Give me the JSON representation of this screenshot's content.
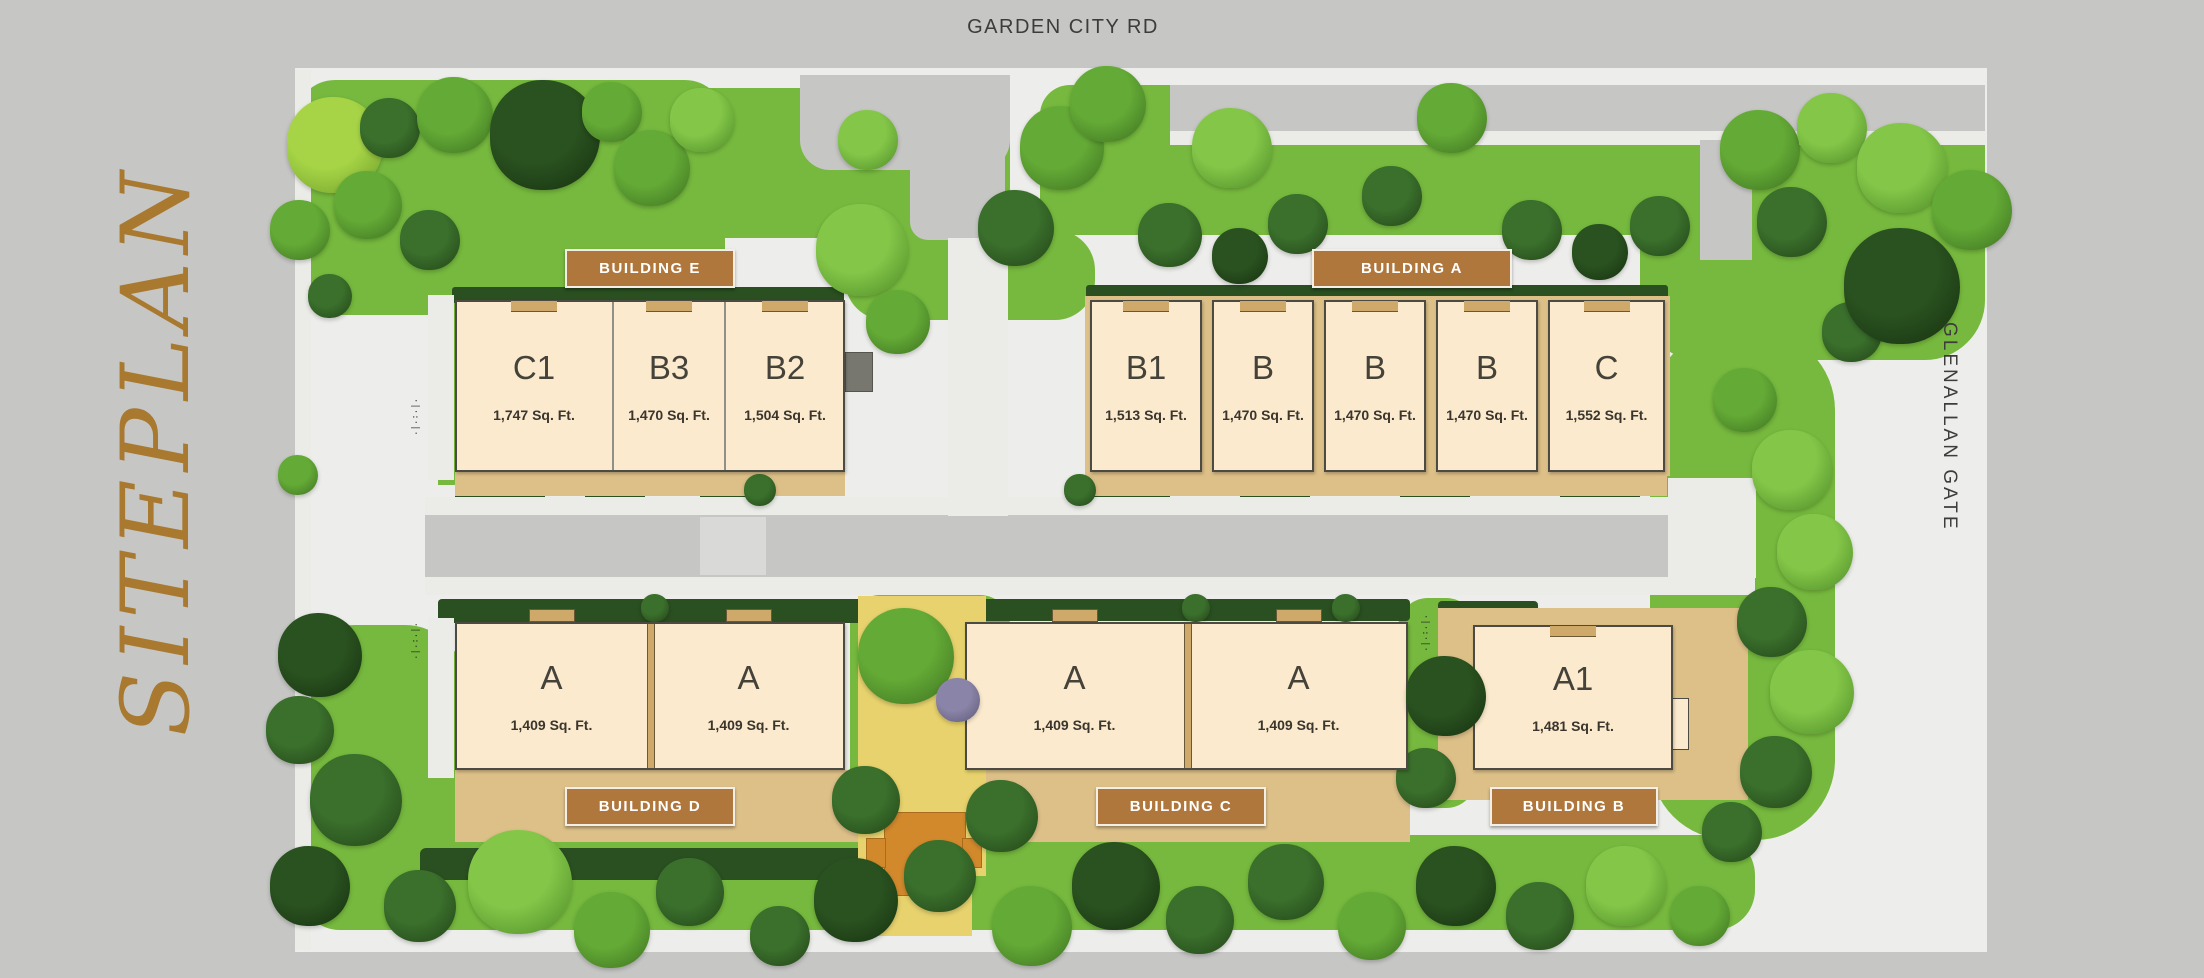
{
  "labels": {
    "top_road": "GARDEN CITY RD",
    "left_title": "SITEPLAN",
    "right_road": "GLENALLAN GATE"
  },
  "colors": {
    "page_bg": "#c6c6c5",
    "site_bg": "#ededeb",
    "building_fill": "#fbeacd",
    "building_border": "#4b4a43",
    "badge_bg": "#b0773c",
    "badge_border": "#f3efe7",
    "badge_text": "#ffffff",
    "unit_text": "#45423a",
    "road": "#c6c6c4",
    "sidewalk": "#ebebe8",
    "apron": "#ddc088",
    "wall_tan": "#cfa96a",
    "hedge": "#2a4f21",
    "grass": "#76b93e",
    "path_yellow": "#e7d26d",
    "patio_orange": "#d2892c",
    "street_text": "#3c3c3c",
    "title_gold": "#a8792e",
    "tree_palette": {
      "lg": [
        "#84c648",
        "#4c8a28"
      ],
      "mg": [
        "#64aa36",
        "#3c7020"
      ],
      "dg": [
        "#3a6f2c",
        "#224417"
      ],
      "dd": [
        "#2a5220",
        "#16300f"
      ],
      "yg": [
        "#a6d446",
        "#6d9c2a"
      ],
      "pu": [
        "#8a84a8",
        "#5c5876"
      ]
    }
  },
  "buildings": [
    {
      "id": "e",
      "badge": {
        "label": "BUILDING E",
        "x": 565,
        "y": 249,
        "w": 170,
        "h": 39
      },
      "box": {
        "x": 455,
        "y": 300,
        "w": 390,
        "h": 172
      },
      "type": "attached",
      "notch": "in",
      "divider": "line",
      "units": [
        {
          "label": "C1",
          "sqft": "1,747 Sq. Ft.",
          "x": 0,
          "w": 158
        },
        {
          "label": "B3",
          "sqft": "1,470 Sq. Ft.",
          "x": 158,
          "w": 112
        },
        {
          "label": "B2",
          "sqft": "1,504 Sq. Ft.",
          "x": 270,
          "w": 120
        }
      ]
    },
    {
      "id": "a",
      "badge": {
        "label": "BUILDING A",
        "x": 1312,
        "y": 249,
        "w": 200,
        "h": 39
      },
      "box": {
        "x": 1090,
        "y": 300,
        "w": 575,
        "h": 172
      },
      "type": "detached",
      "notch": "in",
      "divider": "gap",
      "units": [
        {
          "label": "B1",
          "sqft": "1,513 Sq. Ft.",
          "x": 0,
          "w": 112
        },
        {
          "label": "B",
          "sqft": "1,470 Sq. Ft.",
          "x": 122,
          "w": 102
        },
        {
          "label": "B",
          "sqft": "1,470 Sq. Ft.",
          "x": 234,
          "w": 102
        },
        {
          "label": "B",
          "sqft": "1,470 Sq. Ft.",
          "x": 346,
          "w": 102
        },
        {
          "label": "C",
          "sqft": "1,552 Sq. Ft.",
          "x": 458,
          "w": 117
        }
      ]
    },
    {
      "id": "d",
      "badge": {
        "label": "BUILDING D",
        "x": 565,
        "y": 787,
        "w": 170,
        "h": 39
      },
      "box": {
        "x": 455,
        "y": 622,
        "w": 390,
        "h": 148
      },
      "type": "attached",
      "notch": "out",
      "divider": "tan",
      "units": [
        {
          "label": "A",
          "sqft": "1,409 Sq. Ft.",
          "x": 0,
          "w": 193
        },
        {
          "label": "A",
          "sqft": "1,409 Sq. Ft.",
          "x": 197,
          "w": 193
        }
      ]
    },
    {
      "id": "c",
      "badge": {
        "label": "BUILDING C",
        "x": 1096,
        "y": 787,
        "w": 170,
        "h": 39
      },
      "box": {
        "x": 965,
        "y": 622,
        "w": 443,
        "h": 148
      },
      "type": "attached",
      "notch": "out",
      "divider": "tan",
      "units": [
        {
          "label": "A",
          "sqft": "1,409 Sq. Ft.",
          "x": 0,
          "w": 219
        },
        {
          "label": "A",
          "sqft": "1,409 Sq. Ft.",
          "x": 224,
          "w": 219
        }
      ]
    },
    {
      "id": "b",
      "badge": {
        "label": "BUILDING B",
        "x": 1490,
        "y": 787,
        "w": 168,
        "h": 39
      },
      "box": {
        "x": 1473,
        "y": 625,
        "w": 200,
        "h": 145
      },
      "type": "attached",
      "notch": "in",
      "divider": "line",
      "units": [
        {
          "label": "A1",
          "sqft": "1,481 Sq. Ft.",
          "x": 0,
          "w": 200
        }
      ]
    }
  ],
  "decor": {
    "greens": [
      {
        "x": 295,
        "y": 80,
        "w": 430,
        "h": 235,
        "c": "grass",
        "r": "40px"
      },
      {
        "x": 640,
        "y": 88,
        "w": 370,
        "h": 150,
        "c": "grass",
        "r": "50px"
      },
      {
        "x": 1040,
        "y": 85,
        "w": 945,
        "h": 150,
        "c": "grass",
        "r": "30px"
      },
      {
        "x": 1640,
        "y": 130,
        "w": 345,
        "h": 230,
        "c": "grass",
        "r": "60px"
      },
      {
        "x": 1650,
        "y": 330,
        "w": 185,
        "h": 510,
        "c": "grass",
        "r": "80px"
      },
      {
        "x": 300,
        "y": 835,
        "w": 1455,
        "h": 95,
        "c": "grass",
        "r": "40px"
      },
      {
        "x": 295,
        "y": 625,
        "w": 170,
        "h": 300,
        "c": "grass",
        "r": "60px"
      },
      {
        "x": 850,
        "y": 595,
        "w": 160,
        "h": 250,
        "c": "grass",
        "r": "30px"
      },
      {
        "x": 1398,
        "y": 598,
        "w": 78,
        "h": 210,
        "c": "grass",
        "r": "30px"
      },
      {
        "x": 845,
        "y": 230,
        "w": 250,
        "h": 90,
        "c": "grass",
        "r": "40px"
      },
      {
        "x": 438,
        "y": 295,
        "w": 18,
        "h": 190,
        "c": "grass"
      },
      {
        "x": 452,
        "y": 287,
        "w": 392,
        "h": 16,
        "c": "hedge",
        "r": "3px"
      },
      {
        "x": 1086,
        "y": 285,
        "w": 582,
        "h": 16,
        "c": "hedge",
        "r": "3px"
      },
      {
        "x": 438,
        "y": 599,
        "w": 428,
        "h": 24,
        "c": "hedge",
        "r": "4px"
      },
      {
        "x": 960,
        "y": 599,
        "w": 450,
        "h": 22,
        "c": "hedge",
        "r": "4px"
      },
      {
        "x": 1438,
        "y": 601,
        "w": 100,
        "h": 22,
        "c": "hedge",
        "r": "4px"
      },
      {
        "x": 455,
        "y": 488,
        "w": 90,
        "h": 22,
        "c": "hedge",
        "r": "4px"
      },
      {
        "x": 585,
        "y": 488,
        "w": 60,
        "h": 22,
        "c": "hedge",
        "r": "4px"
      },
      {
        "x": 700,
        "y": 488,
        "w": 70,
        "h": 22,
        "c": "hedge",
        "r": "4px"
      },
      {
        "x": 1090,
        "y": 488,
        "w": 80,
        "h": 22,
        "c": "hedge",
        "r": "4px"
      },
      {
        "x": 1240,
        "y": 488,
        "w": 70,
        "h": 22,
        "c": "hedge",
        "r": "4px"
      },
      {
        "x": 1400,
        "y": 488,
        "w": 70,
        "h": 22,
        "c": "hedge",
        "r": "4px"
      },
      {
        "x": 1560,
        "y": 488,
        "w": 80,
        "h": 22,
        "c": "hedge",
        "r": "4px"
      },
      {
        "x": 420,
        "y": 848,
        "w": 500,
        "h": 32,
        "c": "hedge",
        "r": "6px"
      }
    ],
    "roads": [
      {
        "x": 295,
        "y": 70,
        "w": 16,
        "h": 880,
        "c": "sidewalk"
      },
      {
        "x": 425,
        "y": 497,
        "w": 1330,
        "h": 18,
        "c": "sidewalk"
      },
      {
        "x": 425,
        "y": 577,
        "w": 1330,
        "h": 18,
        "c": "sidewalk"
      },
      {
        "x": 425,
        "y": 515,
        "w": 1330,
        "h": 62,
        "c": "road"
      },
      {
        "x": 800,
        "y": 75,
        "w": 210,
        "h": 95,
        "c": "road",
        "r": "0 0 30px 30px"
      },
      {
        "x": 910,
        "y": 75,
        "w": 95,
        "h": 165,
        "c": "road",
        "r": "0 0 18px 18px"
      },
      {
        "x": 948,
        "y": 238,
        "w": 60,
        "h": 278,
        "c": "sidewalk"
      },
      {
        "x": 1170,
        "y": 85,
        "w": 815,
        "h": 46,
        "c": "road"
      },
      {
        "x": 1170,
        "y": 131,
        "w": 815,
        "h": 14,
        "c": "sidewalk"
      },
      {
        "x": 1700,
        "y": 140,
        "w": 52,
        "h": 120,
        "c": "road"
      },
      {
        "x": 1668,
        "y": 478,
        "w": 88,
        "h": 100,
        "c": "sidewalk"
      },
      {
        "x": 700,
        "y": 517,
        "w": 66,
        "h": 58,
        "c": "#d9d9d7"
      },
      {
        "x": 428,
        "y": 295,
        "w": 26,
        "h": 185,
        "c": "sidewalk"
      },
      {
        "x": 428,
        "y": 618,
        "w": 26,
        "h": 160,
        "c": "sidewalk"
      },
      {
        "x": 1445,
        "y": 620,
        "w": 26,
        "h": 155,
        "c": "sidewalk"
      }
    ],
    "aprons": [
      {
        "x": 455,
        "y": 470,
        "w": 390,
        "h": 26,
        "c": "apron"
      },
      {
        "x": 1085,
        "y": 472,
        "w": 582,
        "h": 24,
        "c": "apron"
      },
      {
        "x": 1085,
        "y": 296,
        "w": 585,
        "h": 180,
        "c": "apron"
      },
      {
        "x": 455,
        "y": 770,
        "w": 408,
        "h": 72,
        "c": "apron"
      },
      {
        "x": 962,
        "y": 770,
        "w": 448,
        "h": 72,
        "c": "apron"
      },
      {
        "x": 1438,
        "y": 608,
        "w": 310,
        "h": 192,
        "c": "apron"
      },
      {
        "x": 858,
        "y": 596,
        "w": 128,
        "h": 280,
        "c": "path_yellow"
      },
      {
        "x": 872,
        "y": 876,
        "w": 100,
        "h": 60,
        "c": "path_yellow"
      },
      {
        "x": 884,
        "y": 812,
        "w": 80,
        "h": 82,
        "c": "patio_orange",
        "br": "#a96c1e"
      },
      {
        "x": 866,
        "y": 838,
        "w": 18,
        "h": 28,
        "c": "patio_orange",
        "br": "#a96c1e"
      },
      {
        "x": 962,
        "y": 838,
        "w": 18,
        "h": 28,
        "c": "patio_orange",
        "br": "#a96c1e"
      },
      {
        "x": 845,
        "y": 352,
        "w": 26,
        "h": 38,
        "c": "#77776f",
        "br": "#55544e"
      },
      {
        "x": 1671,
        "y": 698,
        "w": 16,
        "h": 50,
        "c": "building_fill",
        "br": "#4b4a43"
      }
    ],
    "trees": [
      [
        335,
        145,
        48,
        "yg"
      ],
      [
        300,
        230,
        30,
        "mg"
      ],
      [
        390,
        128,
        30,
        "dg"
      ],
      [
        455,
        115,
        38,
        "mg"
      ],
      [
        545,
        135,
        55,
        "dd"
      ],
      [
        612,
        112,
        30,
        "mg"
      ],
      [
        652,
        168,
        38,
        "mg"
      ],
      [
        702,
        120,
        32,
        "lg"
      ],
      [
        368,
        205,
        34,
        "mg"
      ],
      [
        430,
        240,
        30,
        "dg"
      ],
      [
        330,
        296,
        22,
        "dg"
      ],
      [
        298,
        475,
        20,
        "mg"
      ],
      [
        862,
        250,
        46,
        "lg",
        "o"
      ],
      [
        898,
        322,
        32,
        "mg",
        "o"
      ],
      [
        1016,
        228,
        38,
        "dg"
      ],
      [
        1062,
        148,
        42,
        "mg"
      ],
      [
        1108,
        104,
        38,
        "mg"
      ],
      [
        868,
        140,
        30,
        "lg"
      ],
      [
        1170,
        235,
        32,
        "dg"
      ],
      [
        1240,
        256,
        28,
        "dd"
      ],
      [
        1298,
        224,
        30,
        "dg"
      ],
      [
        1532,
        230,
        30,
        "dg"
      ],
      [
        1600,
        252,
        28,
        "dd"
      ],
      [
        1660,
        226,
        30,
        "dg"
      ],
      [
        1232,
        148,
        40,
        "lg"
      ],
      [
        1452,
        118,
        35,
        "mg"
      ],
      [
        1392,
        196,
        30,
        "dg"
      ],
      [
        1760,
        150,
        40,
        "mg"
      ],
      [
        1832,
        128,
        35,
        "lg"
      ],
      [
        1902,
        168,
        45,
        "lg"
      ],
      [
        1792,
        222,
        35,
        "dg"
      ],
      [
        1902,
        286,
        58,
        "dd",
        "o"
      ],
      [
        1972,
        210,
        40,
        "mg"
      ],
      [
        1852,
        332,
        30,
        "dg"
      ],
      [
        1745,
        400,
        32,
        "mg"
      ],
      [
        1792,
        470,
        40,
        "lg"
      ],
      [
        1815,
        552,
        38,
        "lg"
      ],
      [
        1772,
        622,
        35,
        "dg"
      ],
      [
        1812,
        692,
        42,
        "lg"
      ],
      [
        1776,
        772,
        36,
        "dg"
      ],
      [
        1732,
        832,
        30,
        "dg"
      ],
      [
        320,
        655,
        42,
        "dd"
      ],
      [
        300,
        730,
        34,
        "dg"
      ],
      [
        356,
        800,
        46,
        "dg"
      ],
      [
        310,
        886,
        40,
        "dd"
      ],
      [
        420,
        906,
        36,
        "dg"
      ],
      [
        520,
        882,
        52,
        "lg"
      ],
      [
        612,
        930,
        38,
        "mg"
      ],
      [
        690,
        892,
        34,
        "dg"
      ],
      [
        780,
        936,
        30,
        "dg"
      ],
      [
        856,
        900,
        42,
        "dd"
      ],
      [
        940,
        876,
        36,
        "dg"
      ],
      [
        1032,
        926,
        40,
        "mg"
      ],
      [
        1116,
        886,
        44,
        "dd"
      ],
      [
        1200,
        920,
        34,
        "dg"
      ],
      [
        1286,
        882,
        38,
        "dg"
      ],
      [
        1372,
        926,
        34,
        "mg"
      ],
      [
        1456,
        886,
        40,
        "dd"
      ],
      [
        1540,
        916,
        34,
        "dg"
      ],
      [
        1626,
        886,
        40,
        "lg"
      ],
      [
        1700,
        916,
        30,
        "mg"
      ],
      [
        906,
        656,
        48,
        "mg",
        "o"
      ],
      [
        958,
        700,
        22,
        "pu",
        "o"
      ],
      [
        866,
        800,
        34,
        "dg"
      ],
      [
        1002,
        816,
        36,
        "dg",
        "o"
      ],
      [
        1446,
        696,
        40,
        "dd",
        "o"
      ],
      [
        1426,
        778,
        30,
        "dg"
      ],
      [
        655,
        608,
        14,
        "dg"
      ],
      [
        1196,
        608,
        14,
        "dg"
      ],
      [
        1346,
        608,
        14,
        "dg"
      ],
      [
        760,
        490,
        16,
        "dg"
      ],
      [
        1080,
        490,
        16,
        "dg"
      ]
    ],
    "marks": [
      {
        "x": 410,
        "y": 398
      },
      {
        "x": 410,
        "y": 622
      },
      {
        "x": 1420,
        "y": 614
      }
    ],
    "mark_glyphs": "·|·:·|·"
  }
}
